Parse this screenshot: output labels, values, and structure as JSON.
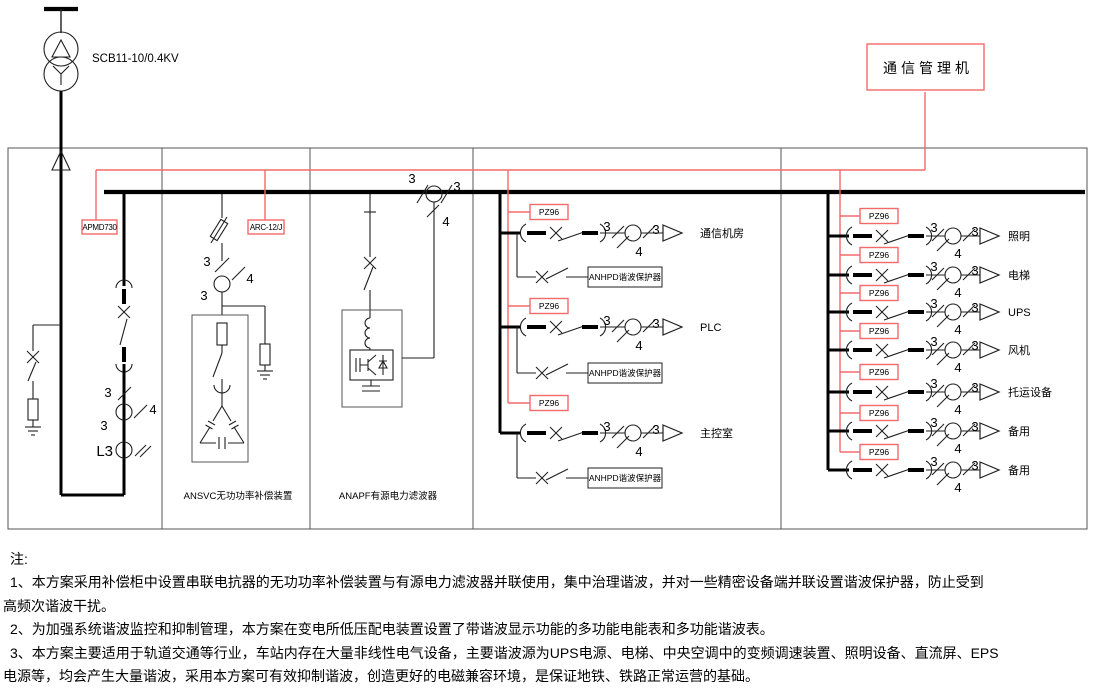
{
  "colors": {
    "line": "#000000",
    "comm_red": "#f46a6a"
  },
  "transformer": {
    "label": "SCB11-10/0.4KV"
  },
  "comm_manager": {
    "label": "通信管理机"
  },
  "incoming": {
    "meter": "APMD730",
    "phase": "L3"
  },
  "ct": {
    "three": "3",
    "four": "4"
  },
  "svc": {
    "controller": "ARC-12/J",
    "label": "ANSVC无功功率补偿装置"
  },
  "apf": {
    "label": "ANAPF有源电力滤波器"
  },
  "meter_label": "PZ96",
  "protector_label": "ANHPD谐波保护器",
  "feeders_a": [
    {
      "name": "通信机房"
    },
    {
      "name": "PLC"
    },
    {
      "name": "主控室"
    }
  ],
  "feeders_b": [
    {
      "name": "照明"
    },
    {
      "name": "电梯"
    },
    {
      "name": "UPS"
    },
    {
      "name": "风机"
    },
    {
      "name": "托运设备"
    },
    {
      "name": "备用"
    },
    {
      "name": "备用"
    }
  ],
  "notes": {
    "heading": "注:",
    "lines": [
      "1、本方案采用补偿柜中设置串联电抗器的无功功率补偿装置与有源电力滤波器并联使用，集中治理谐波，并对一些精密设备端并联设置谐波保护器，防止受到",
      "高频次谐波干扰。",
      "2、为加强系统谐波监控和抑制管理，本方案在变电所低压配电装置设置了带谐波显示功能的多功能电能表和多功能谐波表。",
      "3、本方案主要适用于轨道交通等行业，车站内存在大量非线性电气设备，主要谐波源为UPS电源、电梯、中央空调中的变频调速装置、照明设备、直流屏、EPS",
      "电源等，均会产生大量谐波，采用本方案可有效抑制谐波，创造更好的电磁兼容环境，是保证地铁、铁路正常运营的基础。"
    ]
  }
}
